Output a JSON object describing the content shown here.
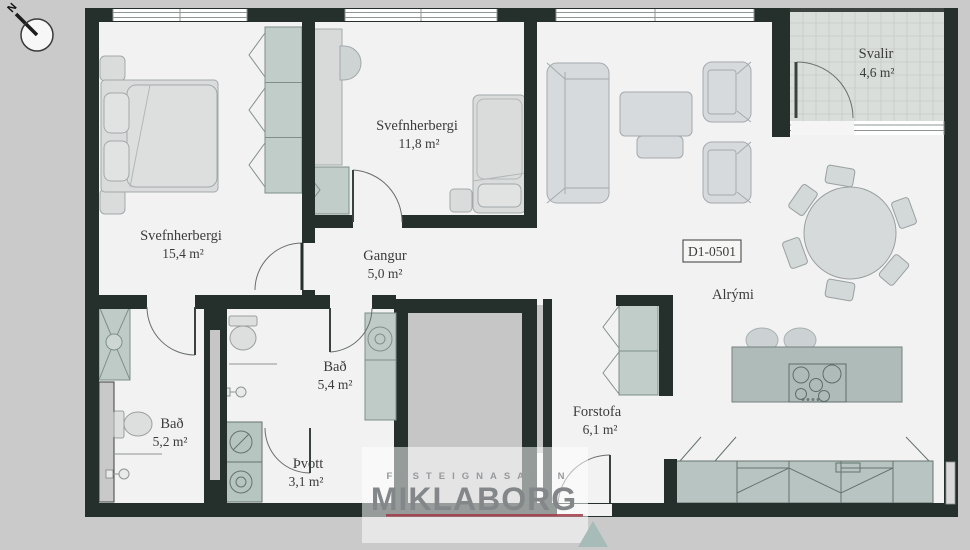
{
  "plan": {
    "unit_label": "D1-0501",
    "compass": {
      "north_label": "N"
    },
    "colors": {
      "background": "#c9cac9",
      "wall": "#25302c",
      "floor": "#f1f2f1",
      "furniture_gray": "#d7dad9",
      "furniture_green": "#bfcbc7",
      "kitchen_island": "#aebbb9",
      "core_fill": "#c6c6c6",
      "balcony_floor": "#dadedb",
      "watermark_red": "#a23a46",
      "watermark_text": "#84878a",
      "watermark_triangle": "#a7bcb8"
    },
    "rooms": {
      "bedroom_large": {
        "name": "Svefnherbergi",
        "area": "15,4 m²"
      },
      "bedroom_small": {
        "name": "Svefnherbergi",
        "area": "11,8 m²"
      },
      "hallway": {
        "name": "Gangur",
        "area": "5,0 m²"
      },
      "bath_main": {
        "name": "Bað",
        "area": "5,4 m²"
      },
      "bath_second": {
        "name": "Bað",
        "area": "5,2 m²"
      },
      "laundry": {
        "name": "Þvott",
        "area": "3,1 m²"
      },
      "entrance": {
        "name": "Forstofa",
        "area": "6,1 m²"
      },
      "living": {
        "name": "Alrými",
        "area": ""
      },
      "balcony": {
        "name": "Svalir",
        "area": "4,6 m²"
      }
    },
    "watermark": {
      "top": "FASTEIGNASALAN",
      "name": "MIKLABORG"
    }
  }
}
